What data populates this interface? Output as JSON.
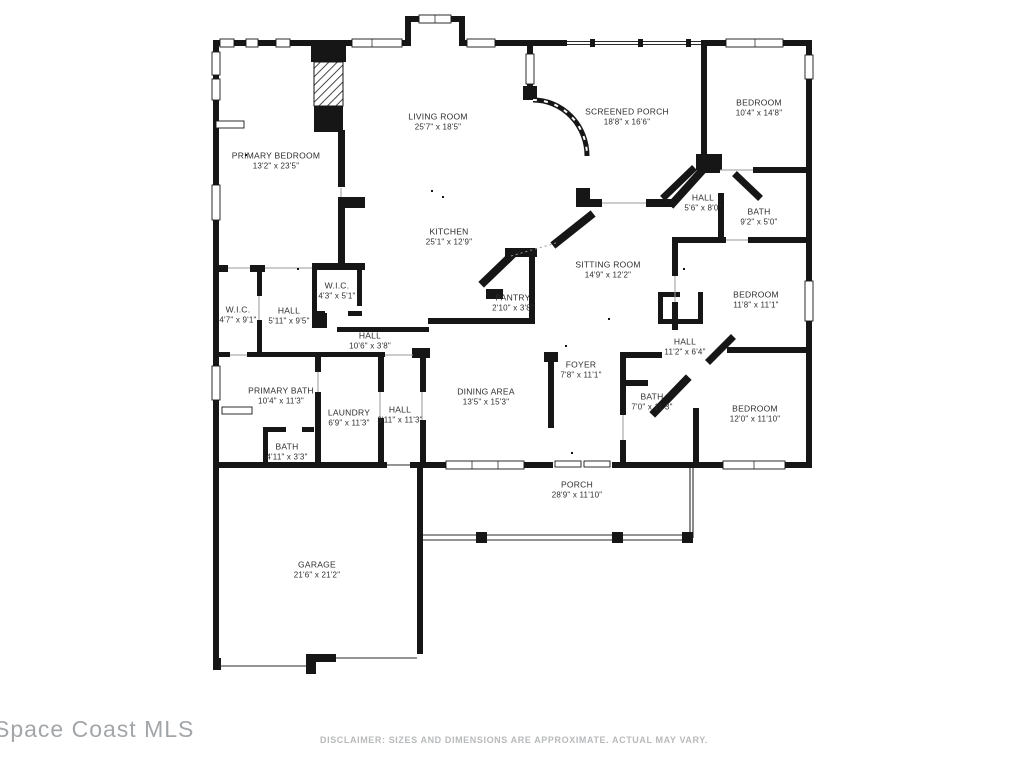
{
  "branding": {
    "mls_label": "Space Coast MLS"
  },
  "footer": {
    "disclaimer": "DISCLAIMER: SIZES AND DIMENSIONS ARE APPROXIMATE. ACTUAL MAY VARY."
  },
  "colors": {
    "wall": "#161616",
    "label_text": "#2e2e2e",
    "watermark": "#a3a6a9",
    "disclaimer_text": "#b7b9bb",
    "background": "#ffffff"
  },
  "floor_plan": {
    "rooms": [
      {
        "name": "LIVING ROOM",
        "dims": "25'7\" x 18'5\""
      },
      {
        "name": "PRIMARY BEDROOM",
        "dims": "13'2\" x 23'5\""
      },
      {
        "name": "SCREENED PORCH",
        "dims": "18'8\" x 16'6\""
      },
      {
        "name": "BEDROOM",
        "dims": "10'4\" x 14'8\""
      },
      {
        "name": "KITCHEN",
        "dims": "25'1\" x 12'9\""
      },
      {
        "name": "HALL",
        "dims": "5'6\" x 8'0\""
      },
      {
        "name": "BATH",
        "dims": "9'2\" x 5'0\""
      },
      {
        "name": "SITTING ROOM",
        "dims": "14'9\" x 12'2\""
      },
      {
        "name": "BEDROOM",
        "dims": "11'8\" x 11'1\""
      },
      {
        "name": "W.I.C.",
        "dims": "4'7\" x 9'1\""
      },
      {
        "name": "HALL",
        "dims": "5'11\" x 9'5\""
      },
      {
        "name": "W.I.C.",
        "dims": "4'3\" x 5'1\""
      },
      {
        "name": "PANTRY",
        "dims": "2'10\" x 3'8\""
      },
      {
        "name": "HALL",
        "dims": "10'6\" x 3'8\""
      },
      {
        "name": "HALL",
        "dims": "11'2\" x 6'4\""
      },
      {
        "name": "FOYER",
        "dims": "7'8\" x 11'1\""
      },
      {
        "name": "DINING AREA",
        "dims": "13'5\" x 15'3\""
      },
      {
        "name": "PRIMARY BATH",
        "dims": "10'4\" x 11'3\""
      },
      {
        "name": "LAUNDRY",
        "dims": "6'9\" x 11'3\""
      },
      {
        "name": "HALL",
        "dims": "3'11\" x 11'3\""
      },
      {
        "name": "BATH",
        "dims": "7'0\" x 11'3\""
      },
      {
        "name": "BEDROOM",
        "dims": "12'0\" x 11'10\""
      },
      {
        "name": "BATH",
        "dims": "4'11\" x 3'3\""
      },
      {
        "name": "PORCH",
        "dims": "28'9\" x 11'10\""
      },
      {
        "name": "GARAGE",
        "dims": "21'6\" x 21'2\""
      }
    ]
  }
}
